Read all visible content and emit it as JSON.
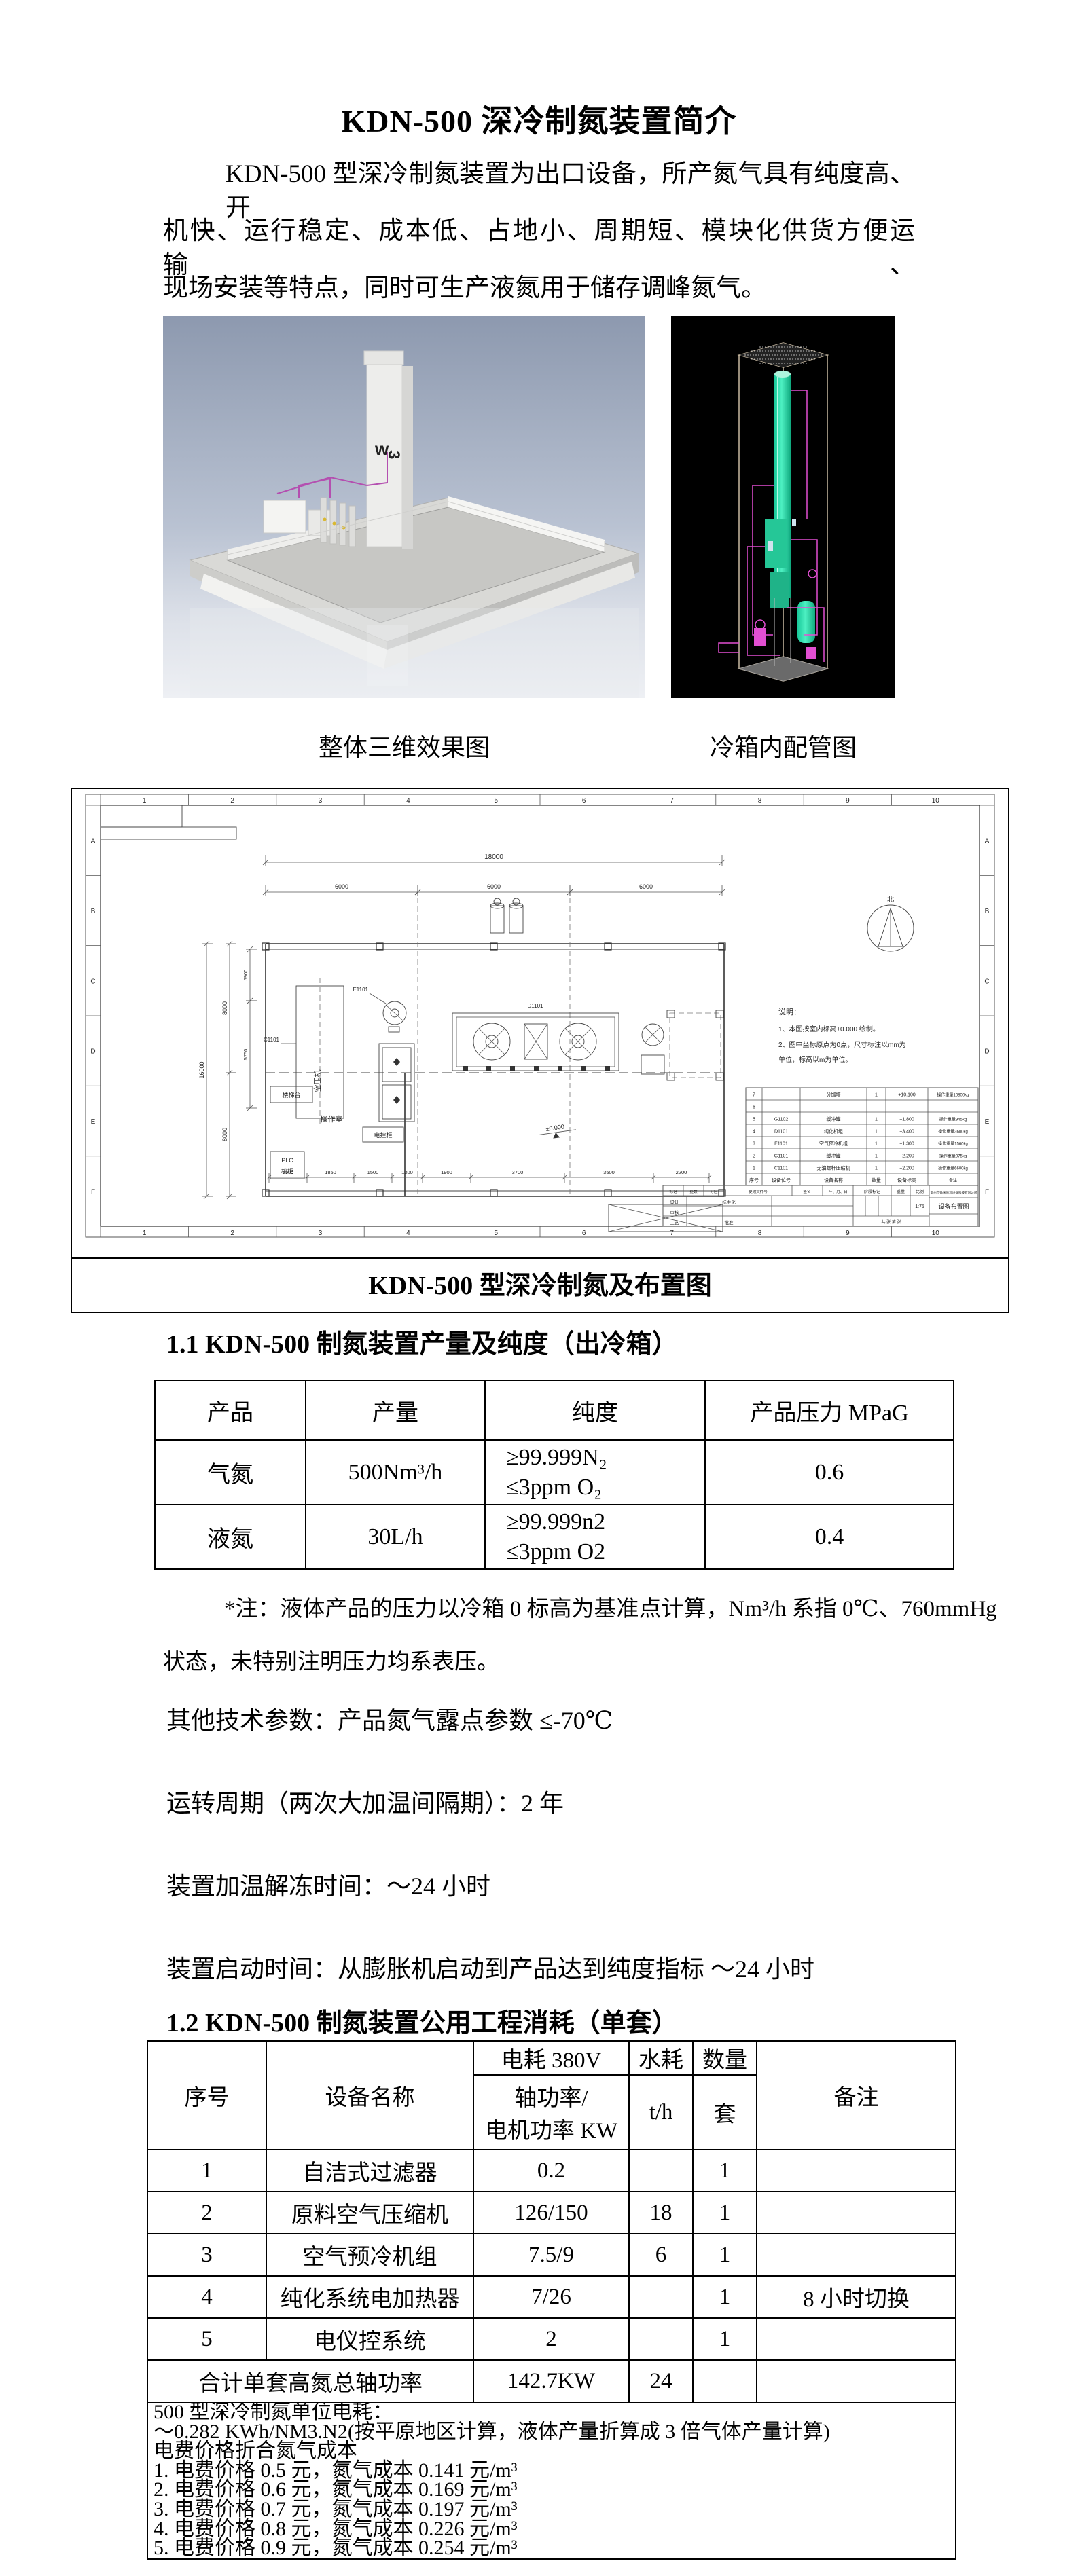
{
  "page": {
    "title": "KDN-500 深冷制氮装置简介"
  },
  "intro": {
    "line1": "KDN-500 型深冷制氮装置为出口设备，所产氮气具有纯度高、开",
    "line2": "机快、运行稳定、成本低、占地小、周期短、模块化供货方便运输、",
    "line3": "现场安装等特点，同时可生产液氮用于储存调峰氮气。"
  },
  "figures": {
    "left_caption": "整体三维效果图",
    "right_caption": "冷箱内配管图",
    "logo_green": "w",
    "logo_blue": "3"
  },
  "drawing": {
    "caption": "KDN-500 型深冷制氮及布置图",
    "grid": {
      "cols": [
        "1",
        "2",
        "3",
        "4",
        "5",
        "6",
        "7",
        "8",
        "9",
        "10"
      ],
      "rows": [
        "A",
        "B",
        "C",
        "D",
        "E",
        "F"
      ]
    },
    "dims": {
      "top": "18000",
      "top_spans": [
        "6000",
        "6000",
        "6000"
      ],
      "left_total": "16000",
      "left_spans": [
        "8000",
        "8000"
      ],
      "side_small": [
        "5900",
        "5750"
      ],
      "bottom": [
        "1500",
        "1850",
        "1500",
        "1200",
        "1900",
        "3700",
        "3500",
        "2200"
      ]
    },
    "labels": {
      "north": "北",
      "compressor": "空压机",
      "tag_c1101": "C1101",
      "tag_d1101": "D1101",
      "tag_e1101": "E1101",
      "stair": "楼梯台",
      "control_room": "操作室",
      "control_cabinet": "电控柜",
      "plc_line1": "PLC",
      "plc_line2": "机柜",
      "elevation": "±0.000"
    },
    "notes": [
      "说明：",
      "1、本图按室内标高±0.000 绘制。",
      "2、图中坐标原点为0点，尺寸标注以mm为",
      "单位，标高以m为单位。"
    ],
    "schedule": {
      "header": [
        "序号",
        "设备位号",
        "设备名称",
        "数量",
        "设备标高",
        "备注"
      ],
      "rows": [
        [
          "7",
          "",
          "分馏塔",
          "1",
          "+10.100",
          "操作重量10800kg"
        ],
        [
          "6",
          "",
          "",
          "",
          "",
          ""
        ],
        [
          "5",
          "G1102",
          "缓冲罐",
          "1",
          "+1.800",
          "操作重量945kg"
        ],
        [
          "4",
          "D1101",
          "纯化机组",
          "1",
          "+3.400",
          "操作重量3600kg"
        ],
        [
          "3",
          "E1101",
          "空气预冷机组",
          "1",
          "+1.300",
          "操作重量1560kg"
        ],
        [
          "2",
          "G1101",
          "缓冲罐",
          "1",
          "+2.200",
          "操作重量975kg"
        ],
        [
          "1",
          "C1101",
          "无油螺杆压缩机",
          "1",
          "+2.200",
          "操作重量6600kg"
        ]
      ]
    },
    "titleblock": {
      "company": "常州市微米低温设备科技有限公司",
      "drawing_name": "设备布置图",
      "stage": "阶段标记",
      "weight": "重量",
      "scale_label": "比例",
      "scale": "1:75",
      "sheet": "共 张 第 张",
      "rev_row": [
        "标记",
        "处数",
        "分区",
        "更改文件号",
        "签名",
        "年、月、日"
      ],
      "roles": [
        "设计",
        "标准化",
        "审核",
        "工艺",
        "批准"
      ]
    }
  },
  "section1": {
    "heading": "1.1 KDN-500 制氮装置产量及纯度（出冷箱）",
    "table": {
      "headers": [
        "产品",
        "产量",
        "纯度",
        "产品压力 MPaG"
      ],
      "rows": [
        {
          "product": "气氮",
          "output": "500Nm³/h",
          "purity1": "≥99.999N₂",
          "purity2": "≤3ppm O₂",
          "pressure": "0.6"
        },
        {
          "product": "液氮",
          "output": "30L/h",
          "purity1": "≥99.999n2",
          "purity2": "≤3ppm O2",
          "pressure": "0.4"
        }
      ]
    },
    "note_line1": "*注：液体产品的压力以冷箱 0 标高为基准点计算，Nm³/h 系指 0℃、760mmHg",
    "note_line2": "状态，未特别注明压力均系表压。",
    "params": [
      "其他技术参数：产品氮气露点参数 ≤-70℃",
      "运转周期（两次大加温间隔期）：2 年",
      "装置加温解冻时间：～24 小时",
      "装置启动时间：从膨胀机启动到产品达到纯度指标 ～24 小时"
    ]
  },
  "section2": {
    "heading": "1.2 KDN-500 制氮装置公用工程消耗（单套）",
    "table": {
      "col_no": "序号",
      "col_device": "设备名称",
      "col_power": "电耗 380V",
      "col_power_sub1": "轴功率/",
      "col_power_sub2": "电机功率 KW",
      "col_water": "水耗",
      "col_water_sub": "t/h",
      "col_qty": "数量",
      "col_qty_sub": "套",
      "col_remark": "备注",
      "rows": [
        {
          "cells": [
            "1",
            "自洁式过滤器",
            "0.2",
            "",
            "1",
            ""
          ]
        },
        {
          "cells": [
            "2",
            "原料空气压缩机",
            "126/150",
            "18",
            "1",
            ""
          ]
        },
        {
          "cells": [
            "3",
            "空气预冷机组",
            "7.5/9",
            "6",
            "1",
            ""
          ]
        },
        {
          "cells": [
            "4",
            "纯化系统电加热器",
            "7/26",
            "",
            "1",
            "8 小时切换"
          ]
        },
        {
          "cells": [
            "5",
            "电仪控系统",
            "2",
            "",
            "1",
            ""
          ]
        }
      ],
      "total": {
        "label": "合计单套高氮总轴功率",
        "power": "142.7KW",
        "water": "24",
        "qty": "",
        "remark": ""
      }
    },
    "unit_cost": [
      "500 型深冷制氮单位电耗：",
      "～0.282 KWh/NM3.N2(按平原地区计算，液体产量折算成 3 倍气体产量计算)",
      "电费价格折合氮气成本",
      "1. 电费价格 0.5 元，氮气成本 0.141 元/m³",
      "2. 电费价格 0.6 元，氮气成本 0.169 元/m³",
      "3. 电费价格 0.7 元，氮气成本 0.197 元/m³",
      "4. 电费价格 0.8 元，氮气成本 0.226 元/m³",
      "5. 电费价格 0.9 元，氮气成本 0.254 元/m³"
    ]
  }
}
